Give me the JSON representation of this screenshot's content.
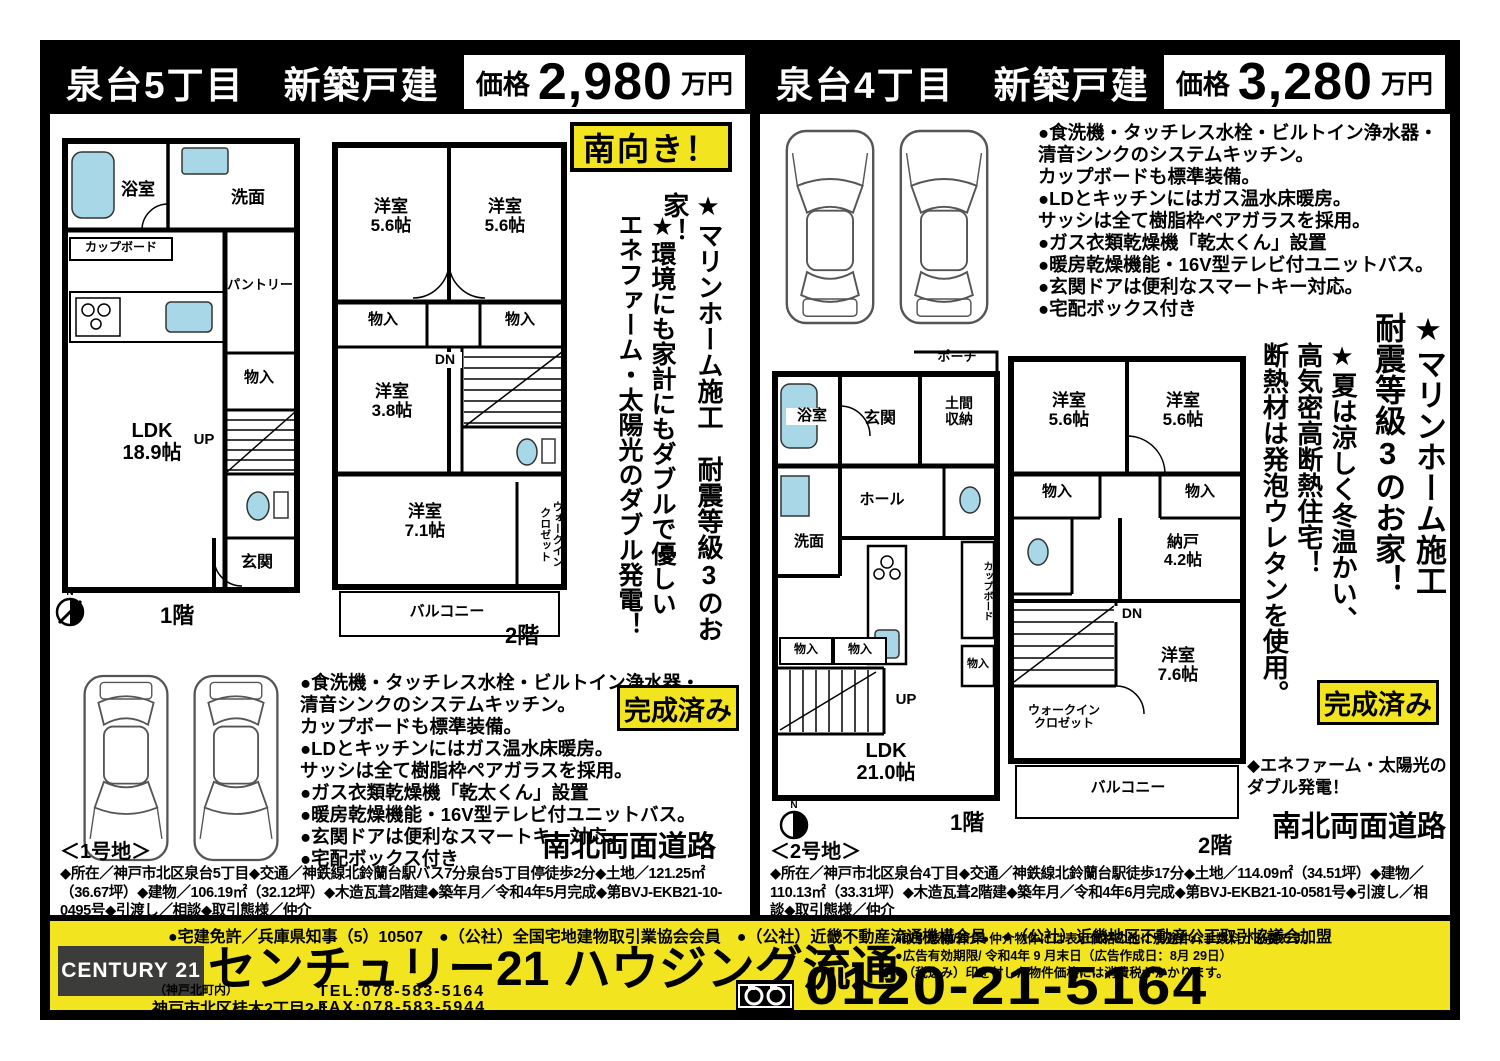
{
  "left": {
    "title": "泉台5丁目　新築戸建",
    "price_label": "価格",
    "price_value": "2,980",
    "price_unit": "万円",
    "south_badge": "南向き！",
    "vcopy_a": "★マリンホーム施工　耐震等級3のお家！",
    "vcopy_b": "★環境にも家計にもダブルで優しい\nエネファーム・太陽光のダブル発電！",
    "features": [
      "●食洗機・タッチレス水栓・ビルトイン浄水器・",
      "清音シンクのシステムキッチン。",
      "カップボードも標準装備。",
      "●LDとキッチンにはガス温水床暖房。",
      "サッシは全て樹脂枠ペアガラスを採用。",
      "●ガス衣類乾燥機「乾太くん」設置",
      "●暖房乾燥機能・16V型テレビ付ユニットバス。",
      "●玄関ドアは便利なスマートキー対応。",
      "●宅配ボックス付き"
    ],
    "completed_badge": "完成済み",
    "road": "南北両面道路",
    "lot": "＜1号地＞",
    "details": "◆所在／神戸市北区泉台5丁目◆交通／神鉄線北鈴蘭台駅バス7分泉台5丁目停徒歩2分◆土地／121.25㎡（36.67坪）◆建物／106.19㎡（32.12坪）◆木造瓦葺2階建◆築年月／令和4年5月完成◆第BVJ-EKB21-10-0495号◆引渡し／相談◆取引態様／仲介",
    "floor1": {
      "caption": "1階",
      "labels": {
        "bath": "浴室",
        "wash": "洗面",
        "cupboard": "カップボード",
        "pantry": "パントリー",
        "closet": "物入",
        "up": "UP",
        "ldk": "LDK\n18.9帖",
        "entrance": "玄関"
      }
    },
    "floor2": {
      "caption": "2階",
      "labels": {
        "room1": "洋室\n5.6帖",
        "room2": "洋室\n5.6帖",
        "closet1": "物入",
        "closet2": "物入",
        "room3": "洋室\n3.8帖",
        "dn": "DN",
        "room4": "洋室\n7.1帖",
        "wic": "ウォークイン\nクロゼット",
        "balcony": "バルコニー"
      }
    }
  },
  "right": {
    "title": "泉台4丁目　新築戸建",
    "price_label": "価格",
    "price_value": "3,280",
    "price_unit": "万円",
    "vcopy_a": "★マリンホーム施工\n耐震等級3のお家！",
    "vcopy_b": "★夏は涼しく冬温かい、\n高気密高断熱住宅！\n断熱材は発泡ウレタンを使用。",
    "features": [
      "●食洗機・タッチレス水栓・ビルトイン浄水器・",
      "清音シンクのシステムキッチン。",
      "カップボードも標準装備。",
      "●LDとキッチンにはガス温水床暖房。",
      "サッシは全て樹脂枠ペアガラスを採用。",
      "●ガス衣類乾燥機「乾太くん」設置",
      "●暖房乾燥機能・16V型テレビ付ユニットバス。",
      "●玄関ドアは便利なスマートキー対応。",
      "●宅配ボックス付き"
    ],
    "completed_badge": "完成済み",
    "ene": "◆エネファーム・太陽光の\nダブル発電！",
    "road": "南北両面道路",
    "lot": "＜2号地＞",
    "details": "◆所在／神戸市北区泉台4丁目◆交通／神鉄線北鈴蘭台駅徒歩17分◆土地／114.09㎡（34.51坪）◆建物／110.13㎡（33.31坪）◆木造瓦葺2階建◆築年月／令和4年6月完成◆第BVJ-EKB21-10-0581号◆引渡し／相談◆取引態様／仲介",
    "floor1": {
      "caption": "1階",
      "labels": {
        "porch": "ポーチ",
        "bath": "浴室",
        "entrance": "玄関",
        "doma": "土間\n収納",
        "hall": "ホール",
        "wash": "洗面",
        "cupboard": "カップボード",
        "closet_a": "物入",
        "closet_b": "物入",
        "closet_c": "物入",
        "up": "UP",
        "ldk": "LDK\n21.0帖"
      }
    },
    "floor2": {
      "caption": "2階",
      "labels": {
        "room1": "洋室\n5.6帖",
        "room2": "洋室\n5.6帖",
        "closet1": "物入",
        "closet2": "物入",
        "nando": "納戸\n4.2帖",
        "dn": "DN",
        "room3": "洋室\n7.6帖",
        "wic": "ウォークイン\nクロゼット",
        "balcony": "バルコニー"
      }
    }
  },
  "footer": {
    "license_line": "●宅建免許／兵庫県知事（5）10507　●（公社）全国宅地建物取引業協会会員　●（公社）近畿不動産流通機構会員　●（公社）近畿地区不動産公正取引協議会加盟",
    "brand": "CENTURY 21",
    "company": "センチュリー21 ハウジング流通",
    "branch_note": "（神戸北町内）",
    "address": "神戸市北区桂木2丁目2-1",
    "tel": "TEL:078-583-5164",
    "fax": "FAX:078-583-5944",
    "notes": [
      "●取引態様/仲介●仲介物件には表示価格の他に別途仲介手数料が必要です。",
      "●広告有効期限/ 令和4年 9 月末日（広告作成日：8月 29日）",
      "●（税込み）印を付した物件価格には消費税がかかります。"
    ],
    "freedial": "0120-21-5164"
  }
}
